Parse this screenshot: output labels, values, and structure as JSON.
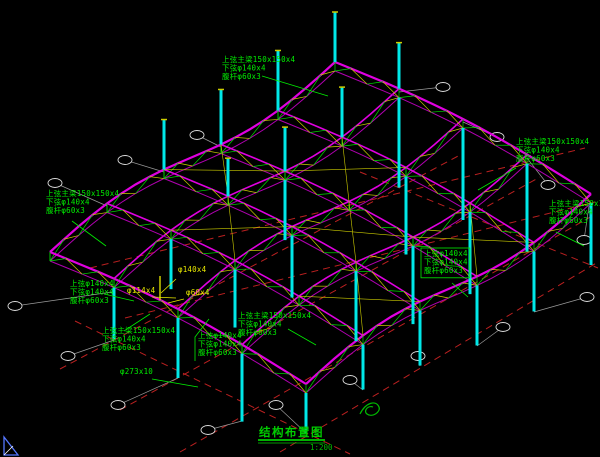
{
  "title_block": {
    "title": "结构布置图",
    "scale": "1:200"
  },
  "colors": {
    "background": "#000000",
    "column_cyan": "#00e8e8",
    "chord_magenta": "#e000e0",
    "chord_dark": "#b000b0",
    "web_green": "#00dd00",
    "web_yellow": "#cccc00",
    "axis_red": "#bb2020",
    "leader_gray": "#9a9a9a",
    "bubble_white": "#dddddd",
    "text_green": "#00ee00",
    "text_yellow": "#e8e800",
    "title_green": "#00cc00",
    "ucs_blue": "#5577ff"
  },
  "annotations": [
    {
      "name": "member-label-top",
      "x": 222,
      "y": 62,
      "color": "green",
      "boxed": false,
      "lines": [
        "上弦主梁150x150x4",
        "下弦φ140x4",
        "腹杆φ60x3"
      ],
      "leader": [
        [
          262,
          76
        ],
        [
          328,
          96
        ]
      ]
    },
    {
      "name": "member-label-right-upper",
      "x": 516,
      "y": 144,
      "color": "green",
      "boxed": false,
      "lines": [
        "上弦主梁150x150x4",
        "下弦φ140x4",
        "腹杆φ60x3"
      ],
      "leader": [
        [
          516,
          168
        ],
        [
          478,
          190
        ]
      ]
    },
    {
      "name": "member-label-right-edge",
      "x": 549,
      "y": 206,
      "color": "green",
      "boxed": false,
      "lines": [
        "上弦主梁150x150x4",
        "下弦φ140x4",
        "腹杆φ60x3"
      ],
      "leader": [
        [
          556,
          232
        ],
        [
          584,
          246
        ]
      ]
    },
    {
      "name": "member-label-left",
      "x": 46,
      "y": 196,
      "color": "green",
      "boxed": false,
      "lines": [
        "上弦主梁150x150x4",
        "下弦φ140x4",
        "腹杆φ60x3"
      ],
      "leader": [
        [
          72,
          221
        ],
        [
          106,
          246
        ]
      ]
    },
    {
      "name": "chord-label-left",
      "x": 70,
      "y": 286,
      "color": "green",
      "boxed": false,
      "lines": [
        "上弦φ140x4",
        "下弦φ140x4",
        "腹杆φ60x3"
      ],
      "leader": [
        [
          104,
          294
        ],
        [
          134,
          301
        ]
      ]
    },
    {
      "name": "pipe-label-114",
      "x": 127,
      "y": 293,
      "color": "yellow",
      "boxed": false,
      "lines": [
        "φ114x4"
      ],
      "leader": [
        [
          152,
          297
        ],
        [
          176,
          298
        ]
      ]
    },
    {
      "name": "pipe-label-140",
      "x": 178,
      "y": 272,
      "color": "yellow",
      "boxed": false,
      "lines": [
        "φ140x4"
      ],
      "leader": [
        [
          176,
          279
        ],
        [
          161,
          293
        ]
      ]
    },
    {
      "name": "pipe-label-60",
      "x": 186,
      "y": 295,
      "color": "yellow",
      "boxed": false,
      "lines": [
        "φ60x4"
      ],
      "leader": [
        [
          184,
          299
        ],
        [
          168,
          303
        ]
      ]
    },
    {
      "name": "chord-label-mid",
      "x": 198,
      "y": 338,
      "color": "green",
      "boxed": false,
      "lines": [
        "上弦φ140x4",
        "下弦φ140x4",
        "腹杆φ60x3"
      ],
      "leader": [
        [
          195,
          361
        ],
        [
          195,
          337
        ],
        [
          209,
          319
        ]
      ]
    },
    {
      "name": "member-label-bottom-left",
      "x": 102,
      "y": 333,
      "color": "green",
      "boxed": false,
      "lines": [
        "上弦主梁150x150x4",
        "下弦φ140x4",
        "腹杆φ60x3"
      ],
      "leader": [
        [
          124,
          331
        ],
        [
          150,
          314
        ]
      ]
    },
    {
      "name": "member-label-bottom-mid",
      "x": 238,
      "y": 318,
      "color": "green",
      "boxed": false,
      "lines": [
        "上弦主梁150x150x4",
        "下弦φ140x4",
        "腹杆φ60x3"
      ],
      "leader": [
        [
          288,
          329
        ],
        [
          316,
          345
        ]
      ]
    },
    {
      "name": "chord-label-boxed",
      "x": 424,
      "y": 256,
      "color": "green",
      "boxed": true,
      "lines": [
        "上弦φ140x4",
        "下弦φ140x4",
        "腹杆φ60x3"
      ],
      "leader": [
        [
          452,
          283
        ],
        [
          468,
          297
        ]
      ]
    },
    {
      "name": "pipe-label-273",
      "x": 120,
      "y": 374,
      "color": "green",
      "boxed": false,
      "lines": [
        "φ273x10"
      ],
      "leader": [
        [
          152,
          379
        ],
        [
          198,
          387
        ]
      ]
    }
  ],
  "grid_bubbles": [
    {
      "x": 15,
      "y": 306,
      "ax": 112,
      "ay": 292
    },
    {
      "x": 68,
      "y": 356,
      "ax": 114,
      "ay": 340
    },
    {
      "x": 118,
      "y": 405,
      "ax": 178,
      "ay": 378
    },
    {
      "x": 208,
      "y": 430,
      "ax": 242,
      "ay": 421
    },
    {
      "x": 276,
      "y": 405,
      "ax": 306,
      "ay": 433
    },
    {
      "x": 350,
      "y": 380,
      "ax": 363,
      "ay": 390
    },
    {
      "x": 418,
      "y": 356,
      "ax": 420,
      "ay": 366
    },
    {
      "x": 503,
      "y": 327,
      "ax": 477,
      "ay": 346
    },
    {
      "x": 587,
      "y": 297,
      "ax": 534,
      "ay": 312
    },
    {
      "x": 443,
      "y": 87,
      "ax": 399,
      "ay": 92
    },
    {
      "x": 497,
      "y": 137,
      "ax": 463,
      "ay": 122
    },
    {
      "x": 548,
      "y": 185,
      "ax": 527,
      "ay": 158
    },
    {
      "x": 584,
      "y": 240,
      "ax": 589,
      "ay": 206
    },
    {
      "x": 55,
      "y": 183,
      "ax": 107,
      "ay": 206
    },
    {
      "x": 125,
      "y": 160,
      "ax": 164,
      "ay": 172
    },
    {
      "x": 197,
      "y": 135,
      "ax": 221,
      "ay": 147
    }
  ],
  "axis_lines": [
    [
      280,
      452,
      598,
      262
    ],
    [
      180,
      452,
      592,
      216
    ],
    [
      120,
      410,
      540,
      177
    ],
    [
      60,
      369,
      460,
      155
    ],
    [
      75,
      321,
      350,
      454
    ],
    [
      360,
      172,
      598,
      268
    ],
    [
      90,
      268,
      585,
      148
    ],
    [
      125,
      318,
      595,
      202
    ]
  ]
}
